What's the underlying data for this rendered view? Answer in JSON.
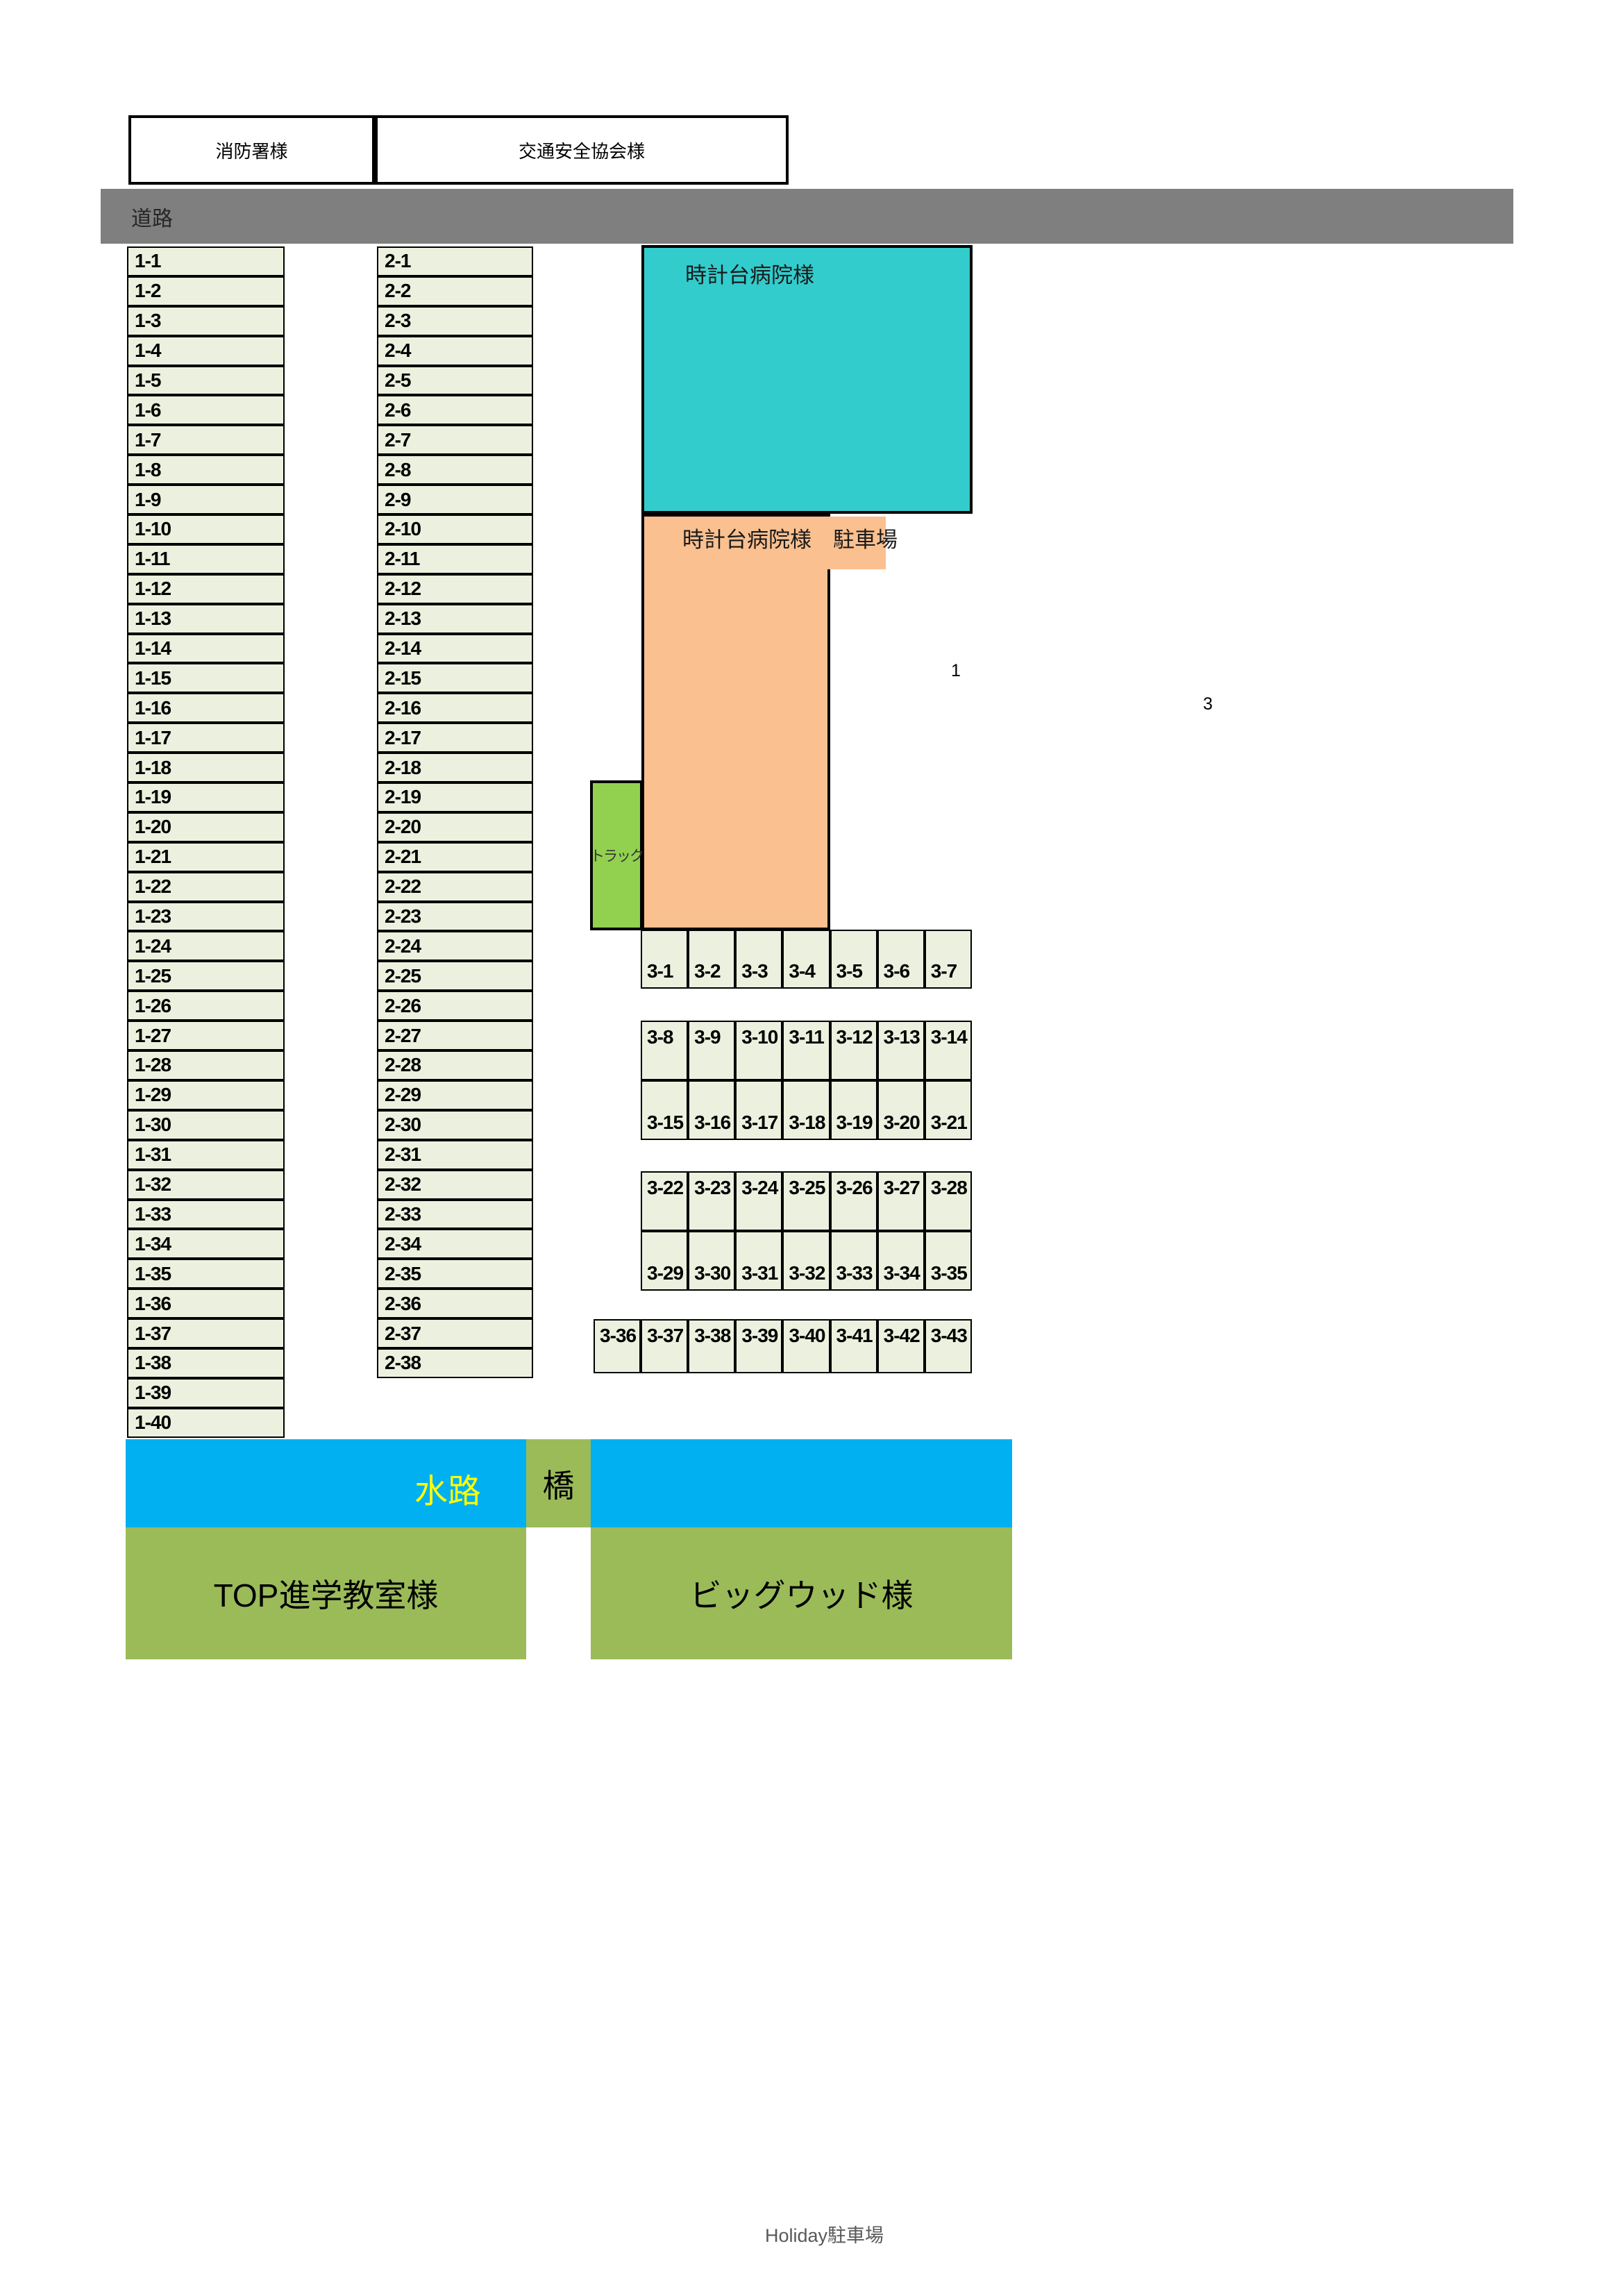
{
  "top": {
    "fire_station": "消防署様",
    "traffic_safety": "交通安全協会様"
  },
  "road": {
    "label": "道路"
  },
  "columns": {
    "col1": [
      "1-1",
      "1-2",
      "1-3",
      "1-4",
      "1-5",
      "1-6",
      "1-7",
      "1-8",
      "1-9",
      "1-10",
      "1-11",
      "1-12",
      "1-13",
      "1-14",
      "1-15",
      "1-16",
      "1-17",
      "1-18",
      "1-19",
      "1-20",
      "1-21",
      "1-22",
      "1-23",
      "1-24",
      "1-25",
      "1-26",
      "1-27",
      "1-28",
      "1-29",
      "1-30",
      "1-31",
      "1-32",
      "1-33",
      "1-34",
      "1-35",
      "1-36",
      "1-37",
      "1-38",
      "1-39",
      "1-40"
    ],
    "col2": [
      "2-1",
      "2-2",
      "2-3",
      "2-4",
      "2-5",
      "2-6",
      "2-7",
      "2-8",
      "2-9",
      "2-10",
      "2-11",
      "2-12",
      "2-13",
      "2-14",
      "2-15",
      "2-16",
      "2-17",
      "2-18",
      "2-19",
      "2-20",
      "2-21",
      "2-22",
      "2-23",
      "2-24",
      "2-25",
      "2-26",
      "2-27",
      "2-28",
      "2-29",
      "2-30",
      "2-31",
      "2-32",
      "2-33",
      "2-34",
      "2-35",
      "2-36",
      "2-37",
      "2-38"
    ]
  },
  "hospital": {
    "building_label": "時計台病院様",
    "parking_label": "時計台病院様　駐車場",
    "truck_label": "トラック"
  },
  "lot3": {
    "row_a": [
      "3-1",
      "3-2",
      "3-3",
      "3-4",
      "3-5",
      "3-6",
      "3-7"
    ],
    "row_b_top": [
      "3-8",
      "3-9",
      "3-10",
      "3-11",
      "3-12",
      "3-13",
      "3-14"
    ],
    "row_b_bottom": [
      "3-15",
      "3-16",
      "3-17",
      "3-18",
      "3-19",
      "3-20",
      "3-21"
    ],
    "row_c_top": [
      "3-22",
      "3-23",
      "3-24",
      "3-25",
      "3-26",
      "3-27",
      "3-28"
    ],
    "row_c_bottom": [
      "3-29",
      "3-30",
      "3-31",
      "3-32",
      "3-33",
      "3-34",
      "3-35"
    ],
    "row_d": [
      "3-36",
      "3-37",
      "3-38",
      "3-39",
      "3-40",
      "3-41",
      "3-42",
      "3-43"
    ]
  },
  "stray": {
    "one": "1",
    "three": "3"
  },
  "waterway": {
    "label": "水路",
    "bridge_label": "橋"
  },
  "tenants": {
    "top_school": "TOP進学教室様",
    "bigwood": "ビッグウッド様"
  },
  "footer": {
    "holiday_parking": "Holiday駐車場"
  },
  "colors": {
    "road_gray": "#7f7f7f",
    "stall_fill": "#ebf1de",
    "hospital_teal": "#33cccc",
    "hospital_parking_orange": "#fac090",
    "truck_green": "#92d050",
    "waterway_blue": "#00b0f0",
    "tenant_olive": "#9bbb59",
    "waterway_text_yellow": "#ffff00"
  }
}
